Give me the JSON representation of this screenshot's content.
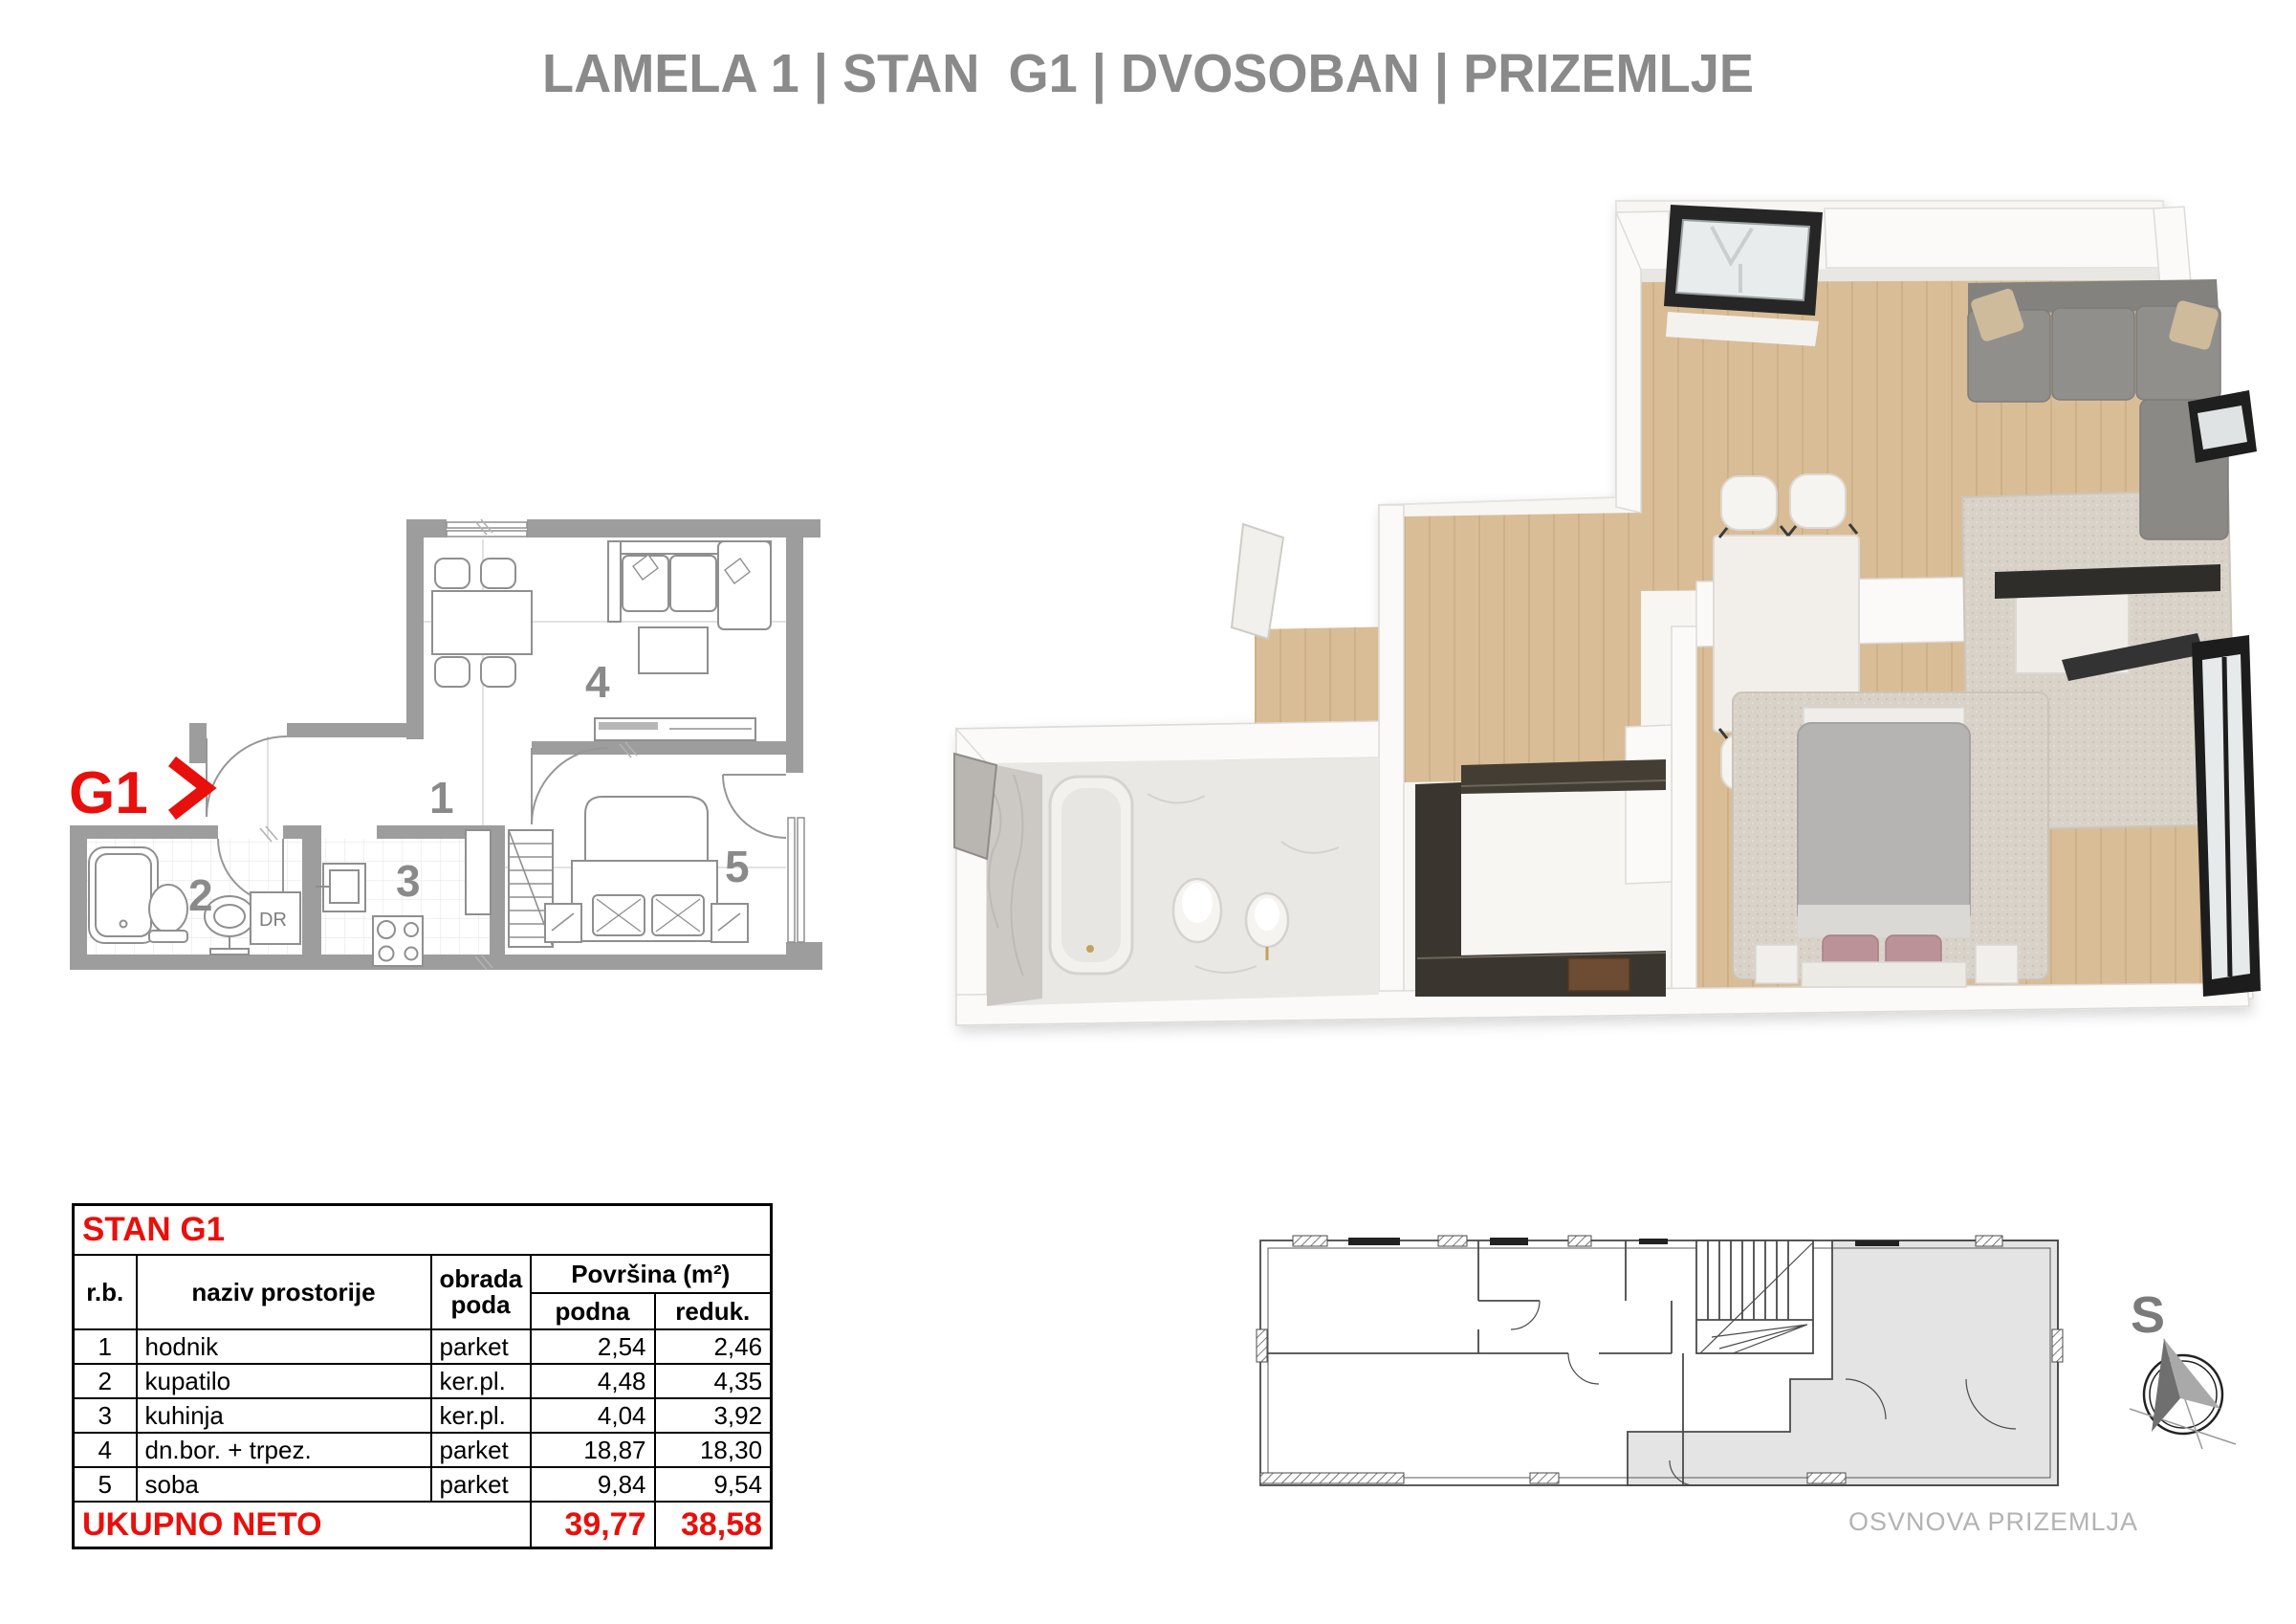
{
  "title": "LAMELA 1 | STAN  G1 | DVOSOBAN | PRIZEMLJE",
  "plan2d": {
    "unit_label": "G1",
    "unit_arrow": "❯",
    "closet_label": "DR",
    "room_numbers": {
      "r1": "1",
      "r2": "2",
      "r3": "3",
      "r4": "4",
      "r5": "5"
    }
  },
  "table": {
    "header_title": "STAN G1",
    "col_rb": "r.b.",
    "col_name": "naziv  prostorije",
    "floor_header": [
      "obrada",
      "poda"
    ],
    "col_area": "Površina (m²)",
    "col_podna": "podna",
    "col_reduk": "reduk.",
    "rows": [
      {
        "rb": "1",
        "name": "hodnik",
        "floor": "parket",
        "podna": "2,54",
        "reduk": "2,46"
      },
      {
        "rb": "2",
        "name": "kupatilo",
        "floor": "ker.pl.",
        "podna": "4,48",
        "reduk": "4,35"
      },
      {
        "rb": "3",
        "name": "kuhinja",
        "floor": "ker.pl.",
        "podna": "4,04",
        "reduk": "3,92"
      },
      {
        "rb": "4",
        "name": "dn.bor. + trpez.",
        "floor": "parket",
        "podna": "18,87",
        "reduk": "18,30"
      },
      {
        "rb": "5",
        "name": "soba",
        "floor": "parket",
        "podna": "9,84",
        "reduk": "9,54"
      }
    ],
    "total_label": "UKUPNO NETO",
    "total_podna": "39,77",
    "total_reduk": "38,58"
  },
  "site_plan": {
    "caption": "OSVNOVA PRIZEMLJA",
    "compass_letter": "S"
  },
  "colors": {
    "accent_red": "#e8100c",
    "title_gray": "#8a8a8a",
    "wall_gray": "#9d9d9d",
    "wood": "#d9bd97",
    "caption_gray": "#b3b3b3"
  }
}
